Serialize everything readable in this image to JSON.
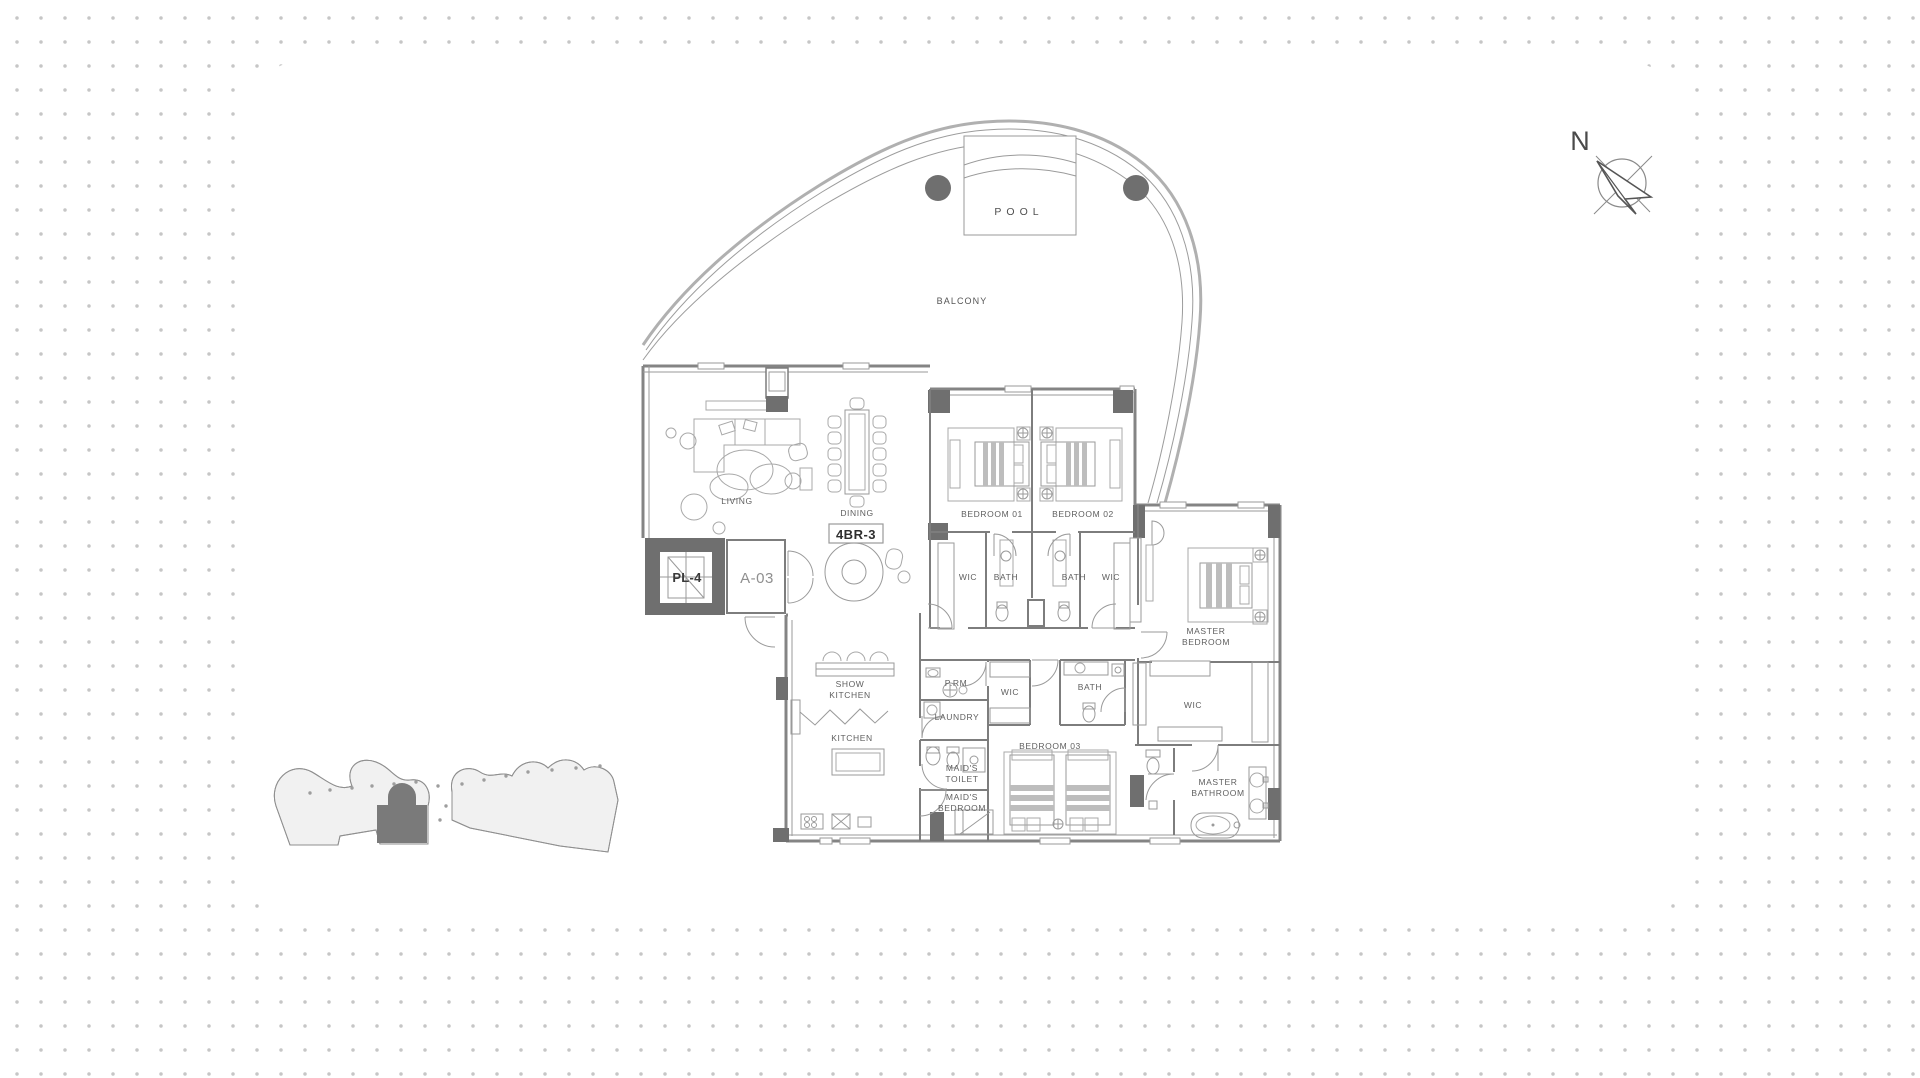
{
  "page": {
    "background": "#ffffff",
    "dot_color": "#c6c6c6",
    "panel_color": "#ffffff",
    "wall_color": "#7d7d7d",
    "dark_fill_color": "#6f6f6f",
    "furniture_line_color": "#a8a8a8",
    "keyplan_highlight_color": "#7a7a7a",
    "pool_marker_color": "#7a7a7a"
  },
  "compass": {
    "label": "N"
  },
  "floorplan": {
    "unit_badge": "4BR-3",
    "core": {
      "elevator": "PL-4",
      "lobby": "A-03"
    },
    "outdoor": {
      "pool": "POOL",
      "balcony": "BALCONY"
    },
    "labels": [
      {
        "id": "pool",
        "cls": "pool",
        "x": 1019,
        "y": 215,
        "lines": [
          "POOL"
        ]
      },
      {
        "id": "balcony",
        "cls": "balcony",
        "x": 962,
        "y": 304,
        "lines": [
          "BALCONY"
        ]
      },
      {
        "id": "living",
        "cls": "room",
        "x": 737,
        "y": 504,
        "lines": [
          "LIVING"
        ]
      },
      {
        "id": "dining",
        "cls": "room",
        "x": 857,
        "y": 516,
        "lines": [
          "DINING"
        ]
      },
      {
        "id": "unit-badge",
        "cls": "badge",
        "x": 856,
        "y": 539,
        "lines": [
          "4BR-3"
        ]
      },
      {
        "id": "elevator-plate",
        "cls": "plate",
        "x": 687,
        "y": 582,
        "lines": [
          "PL-4"
        ]
      },
      {
        "id": "lobby-plate",
        "cls": "lobby",
        "x": 757,
        "y": 583,
        "lines": [
          "A-03"
        ]
      },
      {
        "id": "bedroom-01",
        "cls": "room",
        "x": 992,
        "y": 517,
        "lines": [
          "BEDROOM 01"
        ]
      },
      {
        "id": "bedroom-02",
        "cls": "room",
        "x": 1083,
        "y": 517,
        "lines": [
          "BEDROOM 02"
        ]
      },
      {
        "id": "wic-bedroom01",
        "cls": "room",
        "x": 968,
        "y": 580,
        "lines": [
          "WIC"
        ]
      },
      {
        "id": "bath-bedroom01",
        "cls": "room",
        "x": 1006,
        "y": 580,
        "lines": [
          "BATH"
        ]
      },
      {
        "id": "bath-bedroom02",
        "cls": "room",
        "x": 1074,
        "y": 580,
        "lines": [
          "BATH"
        ]
      },
      {
        "id": "wic-bedroom02",
        "cls": "room",
        "x": 1111,
        "y": 580,
        "lines": [
          "WIC"
        ]
      },
      {
        "id": "master-bedroom",
        "cls": "room",
        "x": 1206,
        "y": 634,
        "lines": [
          "MASTER",
          "BEDROOM"
        ]
      },
      {
        "id": "show-kitchen",
        "cls": "room",
        "x": 850,
        "y": 687,
        "lines": [
          "SHOW",
          "KITCHEN"
        ]
      },
      {
        "id": "powder-room",
        "cls": "room",
        "x": 956,
        "y": 686,
        "lines": [
          "P.RM"
        ]
      },
      {
        "id": "wic-hall",
        "cls": "room",
        "x": 1010,
        "y": 695,
        "lines": [
          "WIC"
        ]
      },
      {
        "id": "bath-bedroom03",
        "cls": "room",
        "x": 1090,
        "y": 690,
        "lines": [
          "BATH"
        ]
      },
      {
        "id": "wic-master",
        "cls": "room",
        "x": 1193,
        "y": 708,
        "lines": [
          "WIC"
        ]
      },
      {
        "id": "laundry",
        "cls": "room",
        "x": 957,
        "y": 720,
        "lines": [
          "LAUNDRY"
        ]
      },
      {
        "id": "kitchen",
        "cls": "room",
        "x": 852,
        "y": 741,
        "lines": [
          "KITCHEN"
        ]
      },
      {
        "id": "bedroom-03",
        "cls": "room",
        "x": 1050,
        "y": 749,
        "lines": [
          "BEDROOM 03"
        ]
      },
      {
        "id": "maids-toilet",
        "cls": "room",
        "x": 962,
        "y": 771,
        "lines": [
          "MAID'S",
          "TOILET"
        ]
      },
      {
        "id": "maids-bedroom",
        "cls": "room",
        "x": 962,
        "y": 800,
        "lines": [
          "MAID'S",
          "BEDROOM"
        ]
      },
      {
        "id": "master-bathroom",
        "cls": "room",
        "x": 1218,
        "y": 785,
        "lines": [
          "MASTER",
          "BATHROOM"
        ]
      },
      {
        "id": "north",
        "cls": "north",
        "x": 1580,
        "y": 150,
        "lines": [
          "N"
        ]
      }
    ]
  }
}
